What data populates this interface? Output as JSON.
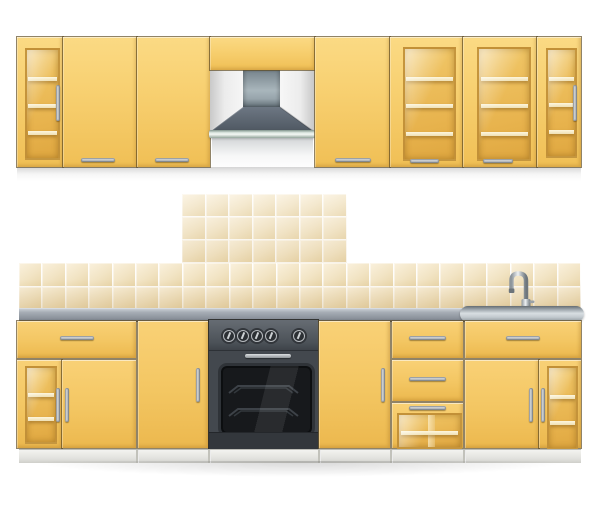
{
  "meta": {
    "description": "Realistic kitchen furniture illustration: yellow wall cabinets with a pyramid cooker hood above, tiled cream backsplash, gray countertop with stainless sink and gooseneck faucet, and yellow base cabinets with an oven range",
    "background": "#ffffff"
  },
  "palette": {
    "cabinet_yellow": "#f5ca66",
    "cabinet_yellow_light": "#fbda84",
    "cabinet_yellow_dark": "#ecb84e",
    "glass_amber": "#e7b24c",
    "shelf_cream": "#fdf6dd",
    "tile_cream": "#f2e4c4",
    "counter_gray": "#8b929b",
    "steel": "#d8dee2",
    "hood_gray": "#5a646f",
    "oven_dark": "#43484e",
    "window_black": "#17191c",
    "handle_metal": "#9ba0a4"
  },
  "upper_row": {
    "label": "wall cabinet row",
    "cabinets": [
      {
        "label": "narrow wall cabinet with glass door and 3 shelves",
        "shelves": 3,
        "handle": "vertical-right"
      },
      {
        "label": "wall cabinet with solid door",
        "handle": "horizontal-bottom"
      },
      {
        "label": "wall cabinet with solid door",
        "handle": "horizontal-bottom"
      },
      {
        "label": "panel above cooker hood"
      },
      {
        "label": "wall cabinet with solid door",
        "handle": "horizontal-bottom"
      },
      {
        "label": "wall cabinet with glass door and 3 shelves",
        "shelves": 3,
        "handle": "horizontal-bottom"
      },
      {
        "label": "wall cabinet with glass door and 3 shelves",
        "shelves": 3,
        "handle": "horizontal-bottom"
      },
      {
        "label": "narrow wall cabinet with glass door and 3 shelves",
        "shelves": 3,
        "handle": "vertical-right"
      }
    ]
  },
  "hood": {
    "label": "pyramid extractor hood with duct",
    "type": "pyramid-extractor"
  },
  "backsplash": {
    "label": "cream ceramic tile backsplash",
    "raised_block": {
      "cols": 7,
      "rows": 3
    },
    "band": {
      "cols": 24,
      "rows": 2
    }
  },
  "counter": {
    "label": "gray countertop"
  },
  "sink": {
    "label": "stainless steel sink section",
    "faucet": "chrome gooseneck faucet"
  },
  "oven": {
    "label": "built-in oven range with control knobs and glass door",
    "knobs": 5,
    "knob_positions_pct": [
      17,
      30,
      43,
      56,
      82
    ],
    "racks": 2
  },
  "lower_row": {
    "label": "base cabinet row",
    "units": [
      {
        "label": "base unit: drawer over glass door and solid door",
        "drawer_shelves": 2,
        "glass_shelves": 2
      },
      {
        "label": "tall base door cabinet",
        "handle": "vertical-right"
      },
      {
        "label": "oven range unit"
      },
      {
        "label": "tall base door cabinet",
        "handle": "vertical-right"
      },
      {
        "label": "drawer unit with two drawers and glass-front drawer",
        "drawers": 3,
        "glass_shelves": 1
      },
      {
        "label": "sink base unit: drawer over solid door and glass door",
        "glass_shelves": 2
      }
    ]
  }
}
